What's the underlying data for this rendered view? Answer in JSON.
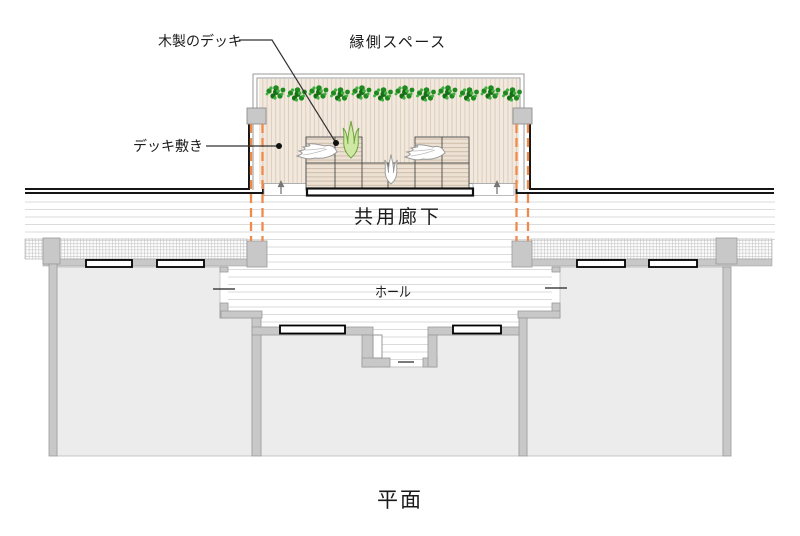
{
  "drawing": {
    "caption": "平面",
    "labels": {
      "wooden_deck": "木製のデッキ",
      "engawa_space": "縁側スペース",
      "deck_paving": "デッキ敷き",
      "common_corridor": "共用廊下",
      "hall": "ホール"
    },
    "colors": {
      "deck_fill": "#f2e9de",
      "deck_stripe": "#ddccbc",
      "bench_fill": "#ece1d3",
      "bench_stripe": "#cdbca9",
      "room_fill": "#ececec",
      "wall_gray": "#c8c8c8",
      "wall_black": "#1a1a1a",
      "floor_line": "#dbdbdb",
      "plant_green": "#1f8a1f",
      "light_plant_green": "#cfe8a3",
      "hidden_line_orange": "#ef8a4a"
    }
  }
}
